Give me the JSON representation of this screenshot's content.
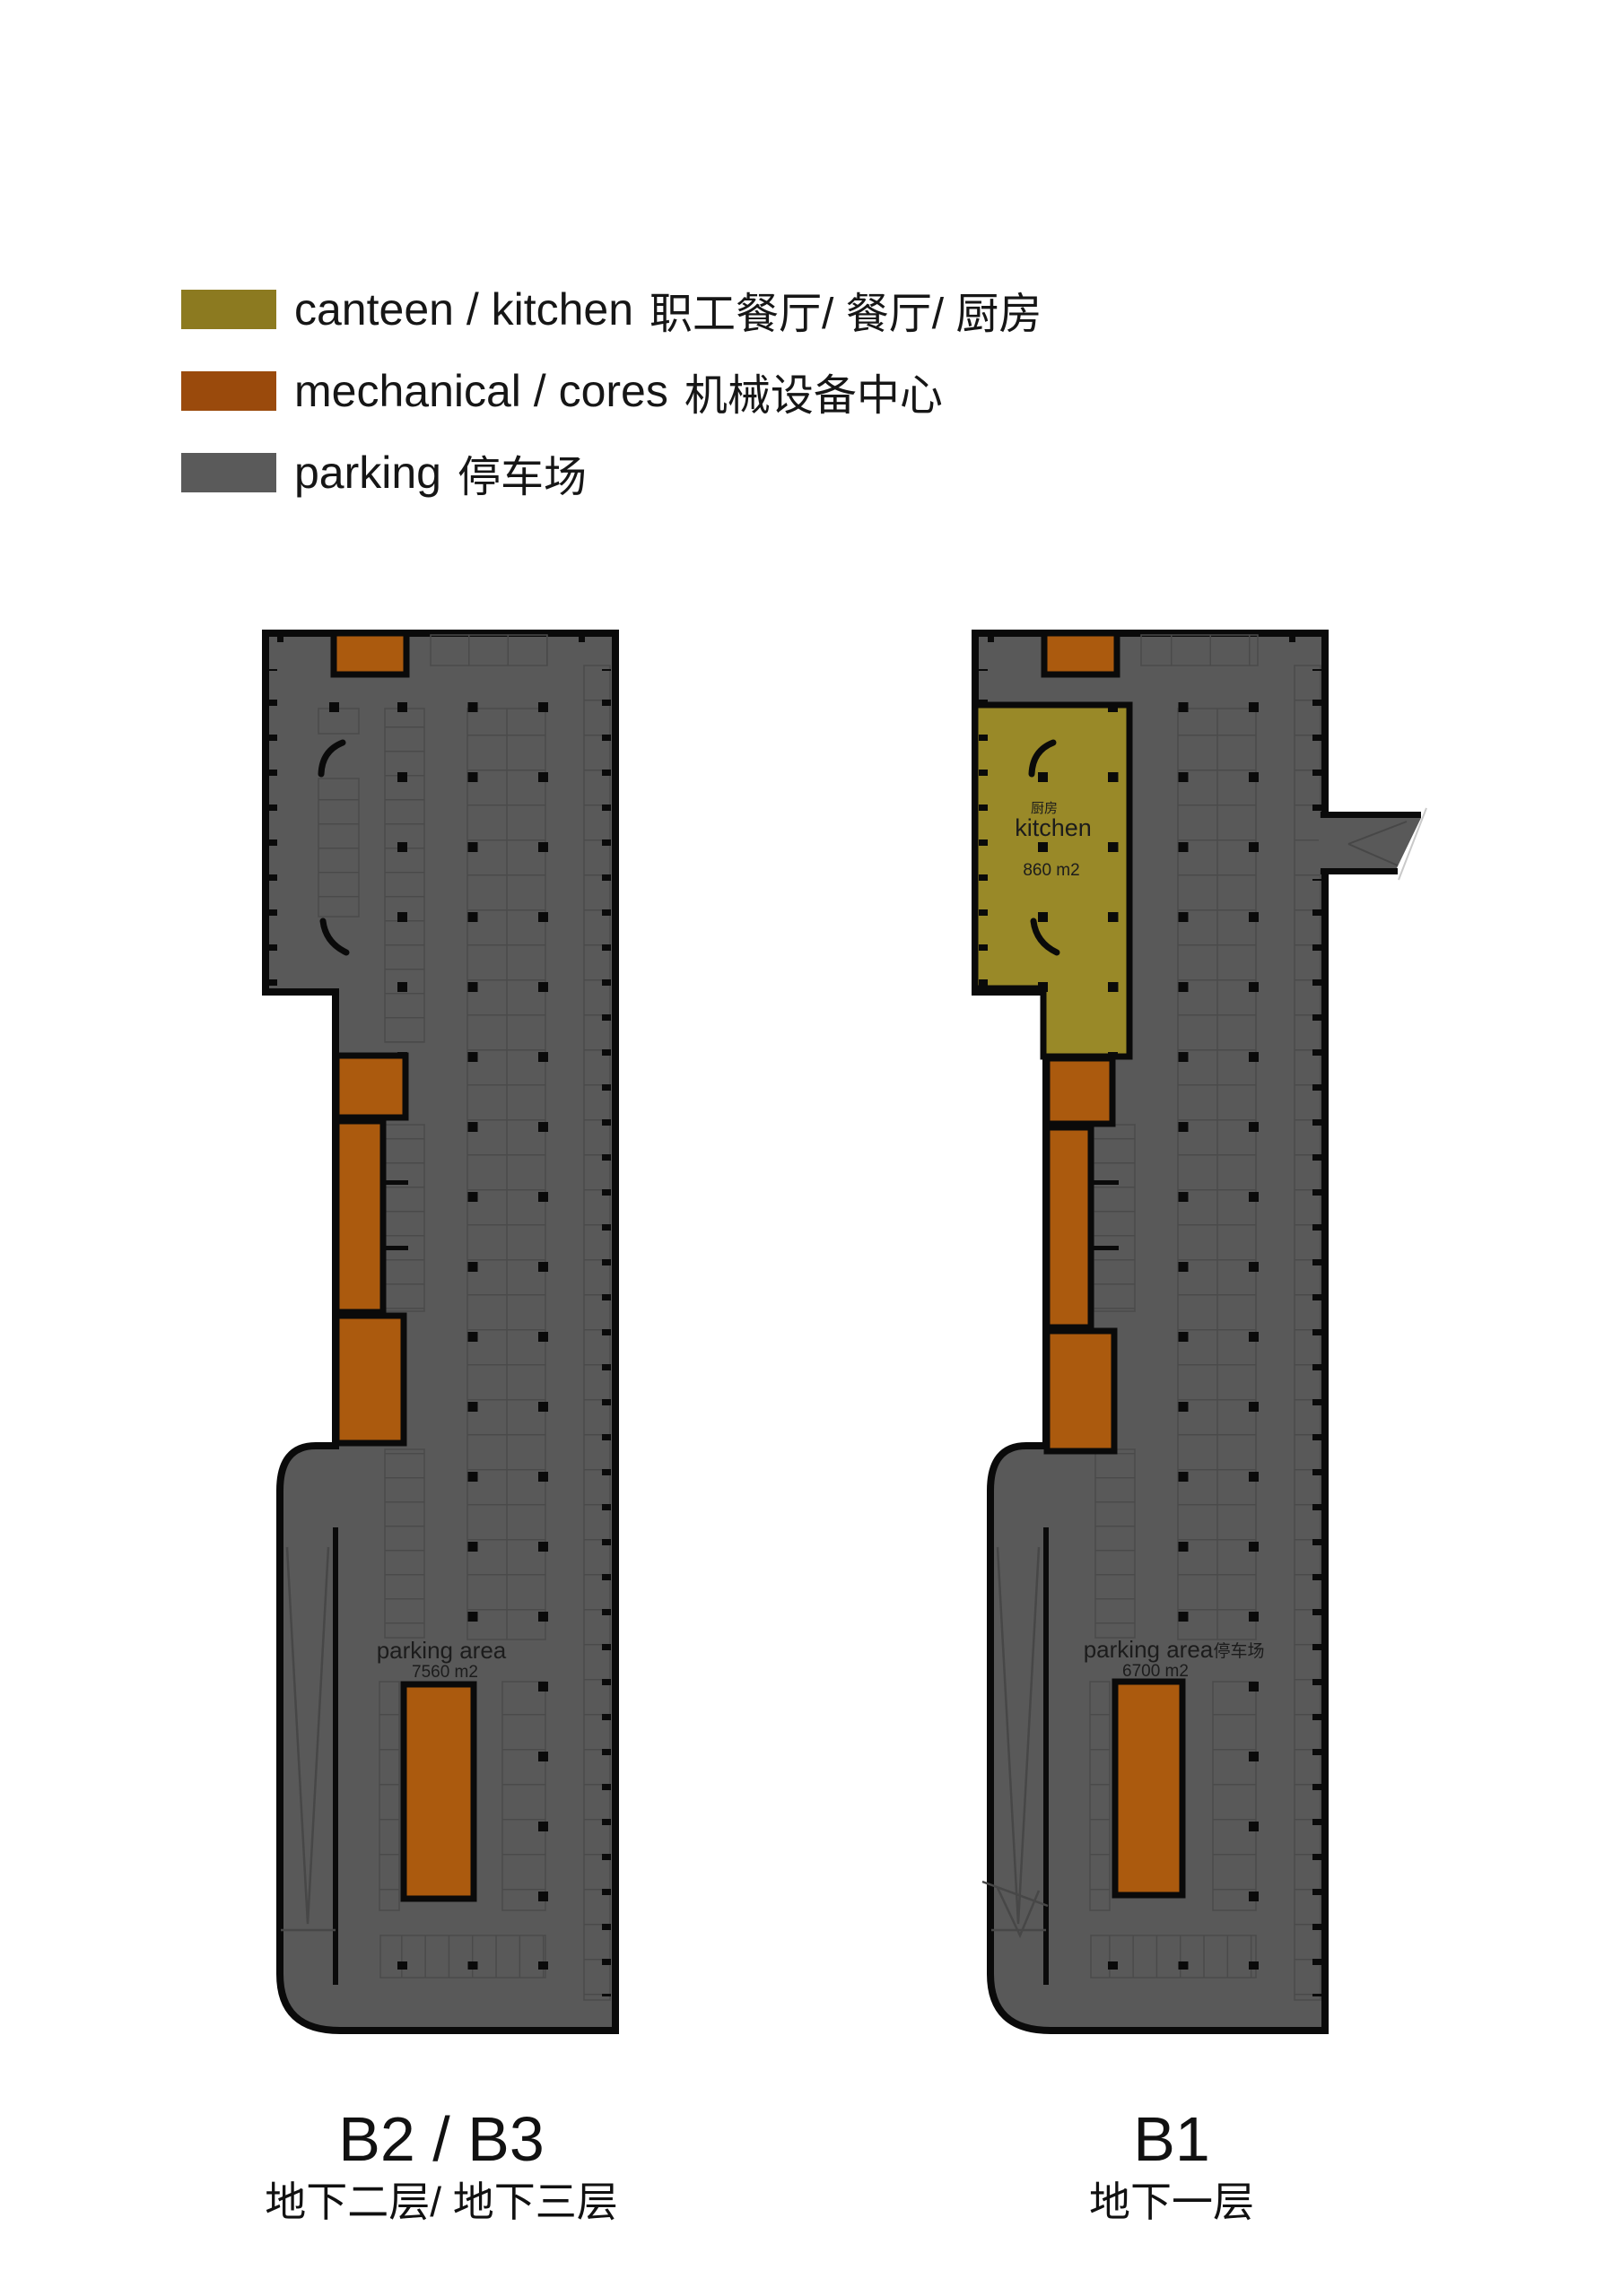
{
  "legend": {
    "items": [
      {
        "label_en": "canteen / kitchen",
        "label_zh": "职工餐厅/ 餐厅/ 厨房",
        "color": "#8c7a20"
      },
      {
        "label_en": "mechanical / cores",
        "label_zh": "机械设备中心",
        "color": "#9a4a0c"
      },
      {
        "label_en": "parking",
        "label_zh": "停车场",
        "color": "#5a5a5a"
      }
    ]
  },
  "plan_colors": {
    "canteen": "#998928",
    "mechanical": "#ab5a0e",
    "parking": "#595959"
  },
  "plans": {
    "b2b3": {
      "parking_label": "parking area",
      "parking_area_value": "7560 m2",
      "title": "B2 / B3",
      "subtitle": "地下二层/ 地下三层"
    },
    "b1": {
      "kitchen_label_zh": "厨房",
      "kitchen_label_en": "kitchen",
      "kitchen_area_value": "860 m2",
      "parking_label": "parking area",
      "parking_label_zh": "停车场",
      "parking_area_value": "6700 m2",
      "title": "B1",
      "subtitle": "地下一层"
    }
  }
}
